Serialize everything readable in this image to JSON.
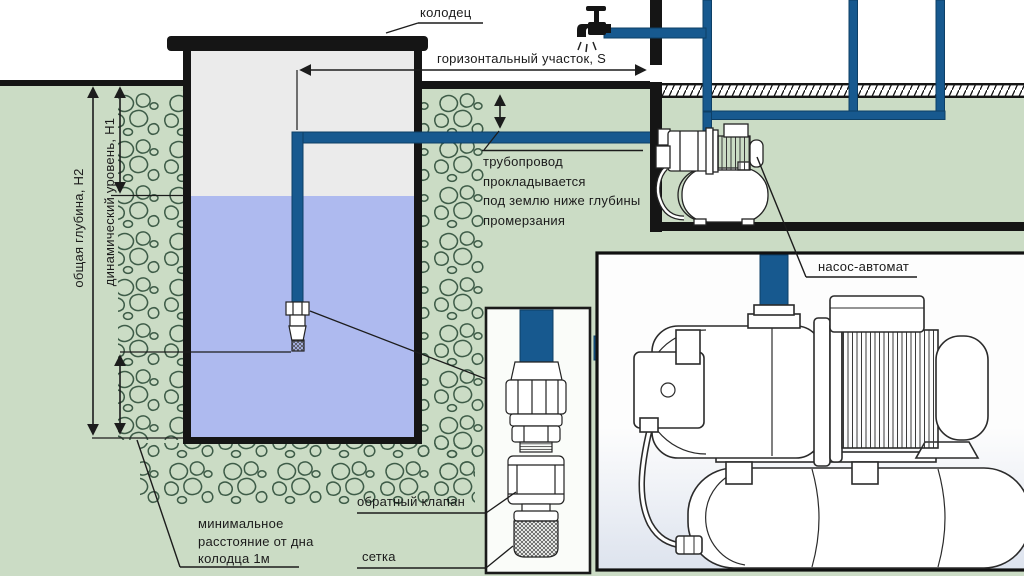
{
  "labels": {
    "well": "колодец",
    "horizontal_section": "горизонтальный участок, S",
    "pipeline_note": "трубопровод\nпрокладывается\nпод землю ниже глубины\nпромерзания",
    "total_depth": "общая глубина, H2",
    "dynamic_level": "динамический уровень, H1",
    "min_distance": "минимальное\nрасстояние от дна\nколодца 1м",
    "check_valve": "обратный клапан",
    "strainer": "сетка",
    "pump_station": "насос-автомат"
  },
  "icons": {
    "faucet": "faucet-icon",
    "foot_valve": "foot-valve-icon",
    "check_valve": "check-valve-icon",
    "strainer": "mesh-strainer-icon"
  },
  "colors": {
    "ground_green": "#cbdcc5",
    "water": "#aebaef",
    "pipe_blue": "#17598f",
    "pipe_edge": "#0d3f66",
    "line_black": "#151515",
    "well_interior": "#ebebeb",
    "stone_stroke": "#3e5c48"
  }
}
